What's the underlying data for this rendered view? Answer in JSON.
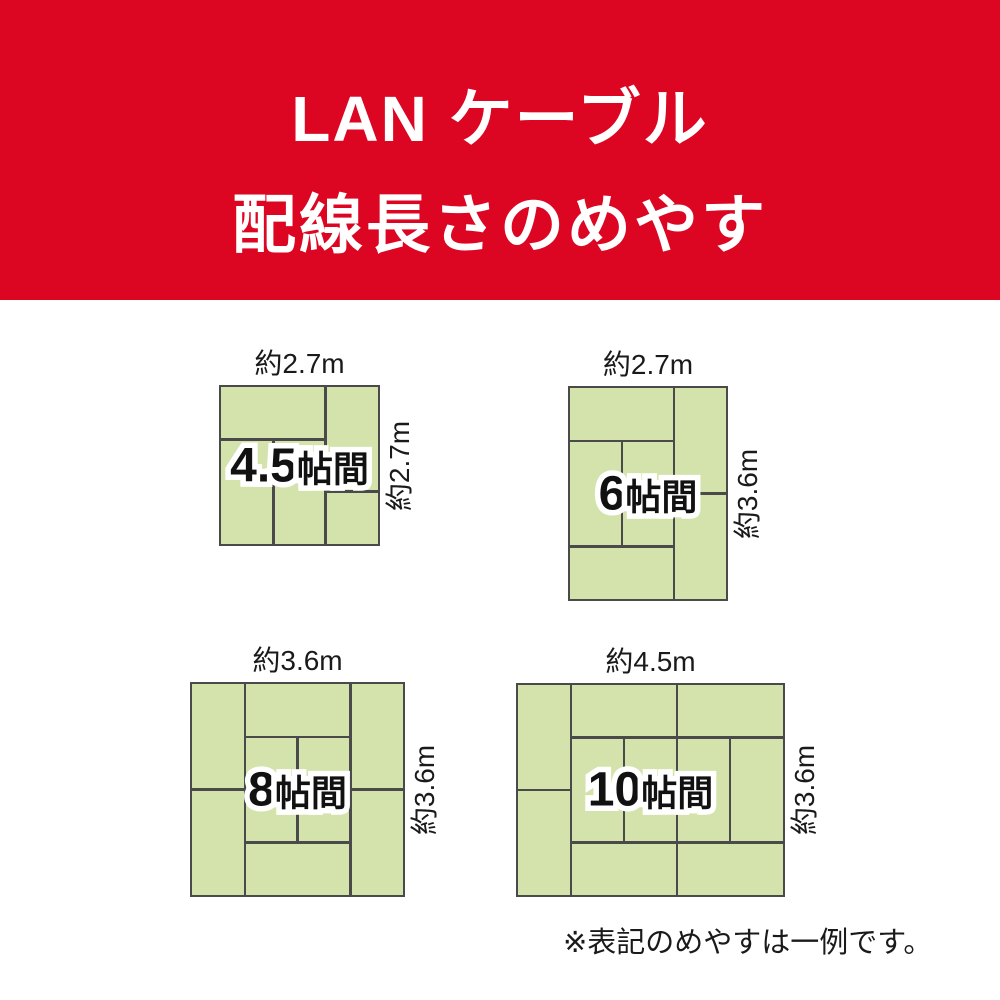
{
  "banner": {
    "line1": "LAN ケーブル",
    "line2": "配線長さのめやす"
  },
  "colors": {
    "banner_bg": "#dc0522",
    "banner_text": "#ffffff",
    "tatami_fill": "#d3e3ab",
    "tatami_line": "#4a4a4a",
    "label_text": "#111111",
    "page_bg": "#ffffff"
  },
  "rooms": [
    {
      "name": "room-4.5-tatami",
      "size_number": "4.5",
      "size_suffix": "帖間",
      "top_dim": "約2.7m",
      "side_dim": "約2.7m",
      "dividers": [
        {
          "o": "h",
          "pos": 33.33,
          "from": 0,
          "to": 66.67
        },
        {
          "o": "v",
          "pos": 66.67,
          "from": 0,
          "to": 100
        },
        {
          "o": "h",
          "pos": 66.67,
          "from": 66.67,
          "to": 100
        },
        {
          "o": "v",
          "pos": 33.33,
          "from": 33.33,
          "to": 100
        }
      ]
    },
    {
      "name": "room-6-tatami",
      "size_number": "6",
      "size_suffix": "帖間",
      "top_dim": "約2.7m",
      "side_dim": "約3.6m",
      "dividers": [
        {
          "o": "v",
          "pos": 66.67,
          "from": 0,
          "to": 100
        },
        {
          "o": "h",
          "pos": 25,
          "from": 0,
          "to": 66.67
        },
        {
          "o": "h",
          "pos": 75,
          "from": 0,
          "to": 66.67
        },
        {
          "o": "v",
          "pos": 33.33,
          "from": 25,
          "to": 75
        },
        {
          "o": "h",
          "pos": 50,
          "from": 66.67,
          "to": 100
        }
      ]
    },
    {
      "name": "room-8-tatami",
      "size_number": "8",
      "size_suffix": "帖間",
      "top_dim": "約3.6m",
      "side_dim": "約3.6m",
      "dividers": [
        {
          "o": "v",
          "pos": 25,
          "from": 0,
          "to": 100
        },
        {
          "o": "v",
          "pos": 75,
          "from": 0,
          "to": 100
        },
        {
          "o": "h",
          "pos": 25,
          "from": 25,
          "to": 75
        },
        {
          "o": "h",
          "pos": 75,
          "from": 25,
          "to": 75
        },
        {
          "o": "v",
          "pos": 50,
          "from": 25,
          "to": 75
        },
        {
          "o": "h",
          "pos": 50,
          "from": 0,
          "to": 25
        },
        {
          "o": "h",
          "pos": 50,
          "from": 75,
          "to": 100
        }
      ]
    },
    {
      "name": "room-10-tatami",
      "size_number": "10",
      "size_suffix": "帖間",
      "top_dim": "約4.5m",
      "side_dim": "約3.6m",
      "dividers": [
        {
          "o": "v",
          "pos": 20,
          "from": 0,
          "to": 100
        },
        {
          "o": "h",
          "pos": 50,
          "from": 0,
          "to": 20
        },
        {
          "o": "v",
          "pos": 60,
          "from": 0,
          "to": 100
        },
        {
          "o": "h",
          "pos": 25,
          "from": 20,
          "to": 100
        },
        {
          "o": "h",
          "pos": 75,
          "from": 20,
          "to": 100
        },
        {
          "o": "v",
          "pos": 40,
          "from": 25,
          "to": 75
        },
        {
          "o": "v",
          "pos": 80,
          "from": 25,
          "to": 75
        }
      ]
    }
  ],
  "footnote": "※表記のめやすは一例です。"
}
